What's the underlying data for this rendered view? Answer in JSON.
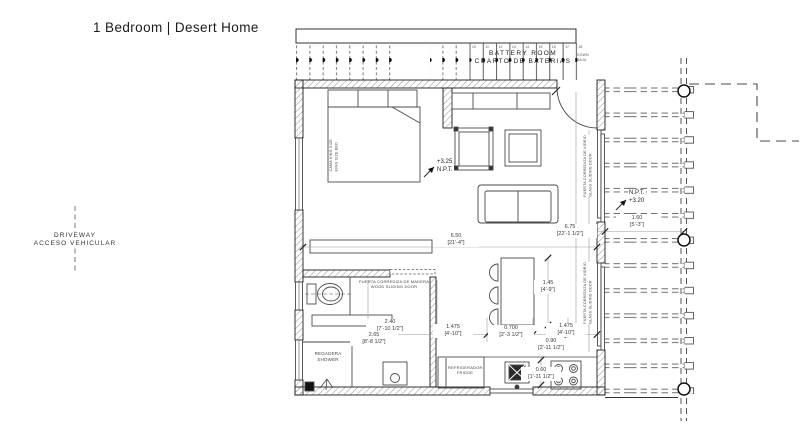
{
  "title": "1 Bedroom | Desert Home",
  "site": {
    "driveway_en": "DRIVEWAY",
    "driveway_es": "ACCESO VEHICULAR"
  },
  "battery_room": {
    "label_en": "BATTERY ROOM",
    "label_es": "CUARTO DE BATERIAS",
    "note_en": "DOWN",
    "note_es": "BAJA",
    "cell_numbers": [
      "10",
      "11",
      "12",
      "13",
      "14",
      "15",
      "16",
      "17",
      "18"
    ]
  },
  "levels": {
    "living_value": "+3.25",
    "living_label": "N.P.T.",
    "terrace_label": "N.P.T.",
    "terrace_value": "+3.20"
  },
  "dimensions": {
    "d650_m": "6.50",
    "d650_ft": "[21'-4\"]",
    "d675_m": "6.75",
    "d675_ft": "[22'-1 1/2\"]",
    "d145_m": "1.45",
    "d145_ft": "[4'-9\"]",
    "d240_m": "2.40",
    "d240_ft": "[7'-10 1/2\"]",
    "d265_m": "2.65",
    "d265_ft": "[8'-8 1/2\"]",
    "d1475a_m": "1.475",
    "d1475a_ft": "[4'-10\"]",
    "d0700_m": "0.700",
    "d0700_ft": "[2'-3 1/2\"]",
    "d090_m": "0.90",
    "d090_ft": "[2'-11 1/2\"]",
    "d1475b_m": "1.475",
    "d1475b_ft": "[4'-10\"]",
    "d160_m": "1.60",
    "d160_ft": "[5'-3\"]",
    "d060_m": "0.60",
    "d060_ft": "[1'-11 1/2\"]"
  },
  "labels": {
    "wood_sliding_door_es": "PUERTA CORREDIZA DE MADERA",
    "wood_sliding_door_en": "WOOD SLIDING DOOR",
    "glass_sliding_door_es": "PUERTA CORREDIZA DE VIDRIO",
    "glass_sliding_door_en": "GLASS SLIDING DOOR",
    "bed_es": "CAMA KING SIZE",
    "bed_en": "KING SIZE BED",
    "shower_es": "REGADERA",
    "shower_en": "SHOWER",
    "fridge_es": "REFRIGERADOR",
    "fridge_en": "FRIDGE"
  },
  "colors": {
    "line": "#1f1f1f",
    "dim_text": "#3a3a3a",
    "hatch": "#8f8f8f"
  }
}
